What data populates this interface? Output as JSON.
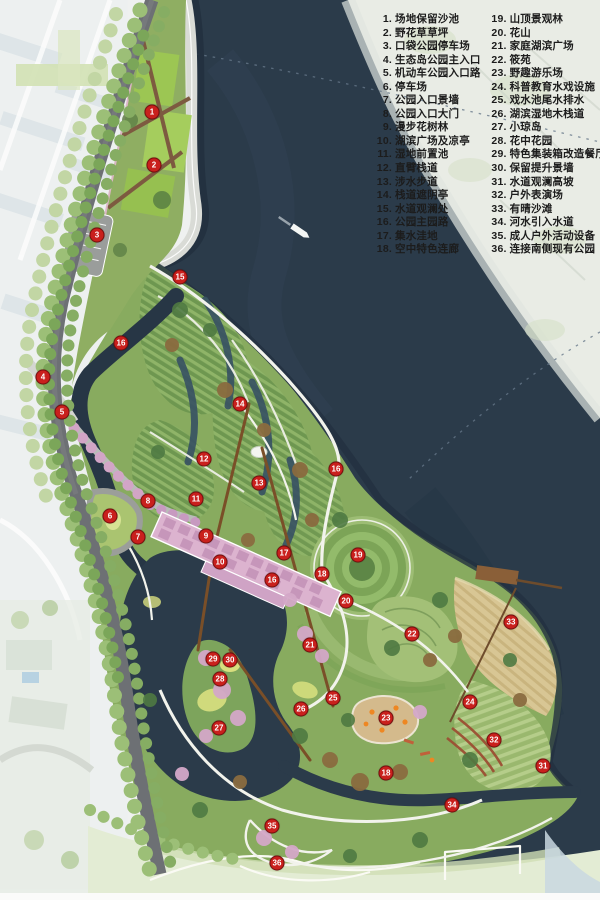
{
  "map": {
    "type": "park-master-plan",
    "boat_icon": "boat"
  },
  "colors": {
    "marker_red": "#c9201d",
    "marker_border": "#7c0e0e",
    "legend_text": "#1c1c1c",
    "lake_water": "#2b3b4a",
    "canal_water": "#273645",
    "park_green": "#88ab5f",
    "mound_green_dark": "#6e9750",
    "mound_green_light": "#8fb468",
    "sand_beach": "#d8c694",
    "path_light": "#f2f3ec",
    "corridor_pink": "#dcb3cf",
    "road_gray": "#6d7074",
    "bank_pale": "#e9ece5"
  },
  "legend": {
    "columns": [
      {
        "items": [
          {
            "n": "1",
            "label": "场地保留沙池"
          },
          {
            "n": "2",
            "label": "野花草草坪"
          },
          {
            "n": "3",
            "label": "口袋公园停车场"
          },
          {
            "n": "4",
            "label": "生态岛公园主入口"
          },
          {
            "n": "5",
            "label": "机动车公园入口路"
          },
          {
            "n": "6",
            "label": "停车场"
          },
          {
            "n": "7",
            "label": "公园入口景墙"
          },
          {
            "n": "8",
            "label": "公园入口大门"
          },
          {
            "n": "9",
            "label": "漫步花树林"
          },
          {
            "n": "10",
            "label": "湖滨广场及凉亭"
          },
          {
            "n": "11",
            "label": "湿地前置池"
          },
          {
            "n": "12",
            "label": "直臂栈道"
          },
          {
            "n": "13",
            "label": "涉水步道"
          },
          {
            "n": "14",
            "label": "栈道遮阴亭"
          },
          {
            "n": "15",
            "label": "水道观澜处"
          },
          {
            "n": "16",
            "label": "公园主园路"
          },
          {
            "n": "17",
            "label": "集水洼地"
          },
          {
            "n": "18",
            "label": "空中特色连廊"
          }
        ]
      },
      {
        "items": [
          {
            "n": "19",
            "label": "山顶景观林"
          },
          {
            "n": "20",
            "label": "花山"
          },
          {
            "n": "21",
            "label": "家庭湖滨广场"
          },
          {
            "n": "22",
            "label": "筱苑"
          },
          {
            "n": "23",
            "label": "野趣游乐场"
          },
          {
            "n": "24",
            "label": "科普教育水戏设施"
          },
          {
            "n": "25",
            "label": "戏水池尾水排水"
          },
          {
            "n": "26",
            "label": "湖滨湿地木栈道"
          },
          {
            "n": "27",
            "label": "小琼岛"
          },
          {
            "n": "28",
            "label": "花中花园"
          },
          {
            "n": "29",
            "label": "特色集装箱改造餐厅"
          },
          {
            "n": "30",
            "label": "保留提升景墙"
          },
          {
            "n": "31",
            "label": "水道观澜高坡"
          },
          {
            "n": "32",
            "label": "户外表演场"
          },
          {
            "n": "33",
            "label": "有晴沙滩"
          },
          {
            "n": "34",
            "label": "河水引入水道"
          },
          {
            "n": "35",
            "label": "成人户外活动设备"
          },
          {
            "n": "36",
            "label": "连接南侧现有公园"
          }
        ]
      }
    ]
  },
  "markers": [
    {
      "n": "1",
      "x": 152,
      "y": 112
    },
    {
      "n": "2",
      "x": 154,
      "y": 165
    },
    {
      "n": "3",
      "x": 97,
      "y": 235
    },
    {
      "n": "15",
      "x": 180,
      "y": 277
    },
    {
      "n": "16",
      "x": 121,
      "y": 343
    },
    {
      "n": "4",
      "x": 43,
      "y": 377
    },
    {
      "n": "14",
      "x": 240,
      "y": 404
    },
    {
      "n": "5",
      "x": 62,
      "y": 412
    },
    {
      "n": "12",
      "x": 204,
      "y": 459
    },
    {
      "n": "16",
      "x": 336,
      "y": 469
    },
    {
      "n": "13",
      "x": 259,
      "y": 483
    },
    {
      "n": "11",
      "x": 196,
      "y": 499
    },
    {
      "n": "8",
      "x": 148,
      "y": 501
    },
    {
      "n": "6",
      "x": 110,
      "y": 516
    },
    {
      "n": "9",
      "x": 206,
      "y": 536
    },
    {
      "n": "7",
      "x": 138,
      "y": 537
    },
    {
      "n": "17",
      "x": 284,
      "y": 553
    },
    {
      "n": "19",
      "x": 358,
      "y": 555
    },
    {
      "n": "10",
      "x": 220,
      "y": 562
    },
    {
      "n": "18",
      "x": 322,
      "y": 574
    },
    {
      "n": "16",
      "x": 272,
      "y": 580
    },
    {
      "n": "20",
      "x": 346,
      "y": 601
    },
    {
      "n": "33",
      "x": 511,
      "y": 622
    },
    {
      "n": "22",
      "x": 412,
      "y": 634
    },
    {
      "n": "21",
      "x": 310,
      "y": 645
    },
    {
      "n": "29",
      "x": 213,
      "y": 659
    },
    {
      "n": "30",
      "x": 230,
      "y": 660
    },
    {
      "n": "28",
      "x": 220,
      "y": 679
    },
    {
      "n": "25",
      "x": 333,
      "y": 698
    },
    {
      "n": "24",
      "x": 470,
      "y": 702
    },
    {
      "n": "26",
      "x": 301,
      "y": 709
    },
    {
      "n": "23",
      "x": 386,
      "y": 718
    },
    {
      "n": "27",
      "x": 219,
      "y": 728
    },
    {
      "n": "32",
      "x": 494,
      "y": 740
    },
    {
      "n": "31",
      "x": 543,
      "y": 766
    },
    {
      "n": "18",
      "x": 386,
      "y": 773
    },
    {
      "n": "34",
      "x": 452,
      "y": 805
    },
    {
      "n": "35",
      "x": 272,
      "y": 826
    },
    {
      "n": "36",
      "x": 277,
      "y": 863
    }
  ]
}
